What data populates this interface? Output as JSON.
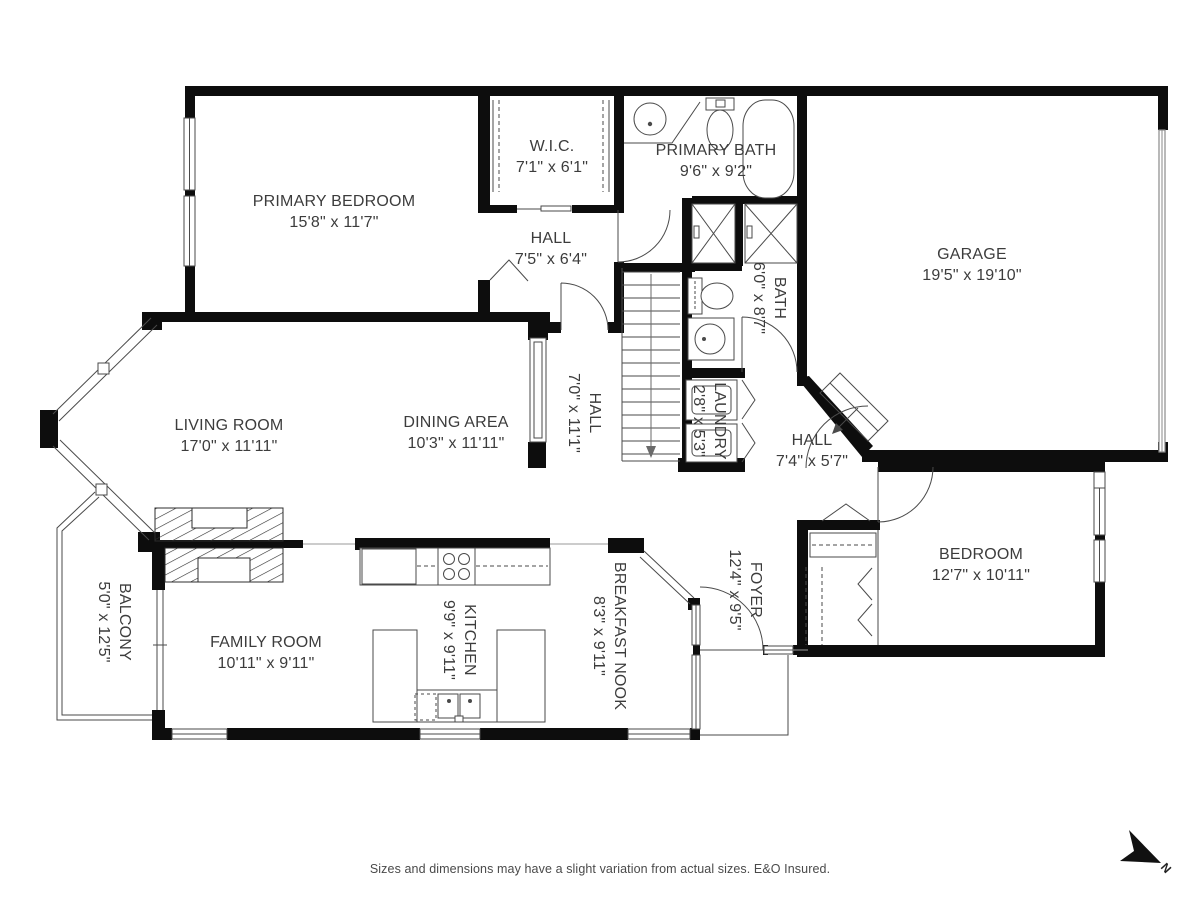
{
  "rooms": [
    {
      "id": "primary-bedroom",
      "name": "PRIMARY BEDROOM",
      "dims": "15'8\" x 11'7\""
    },
    {
      "id": "wic",
      "name": "W.I.C.",
      "dims": "7'1\" x 6'1\""
    },
    {
      "id": "primary-bath",
      "name": "PRIMARY BATH",
      "dims": "9'6\" x 9'2\""
    },
    {
      "id": "hall-upper",
      "name": "HALL",
      "dims": "7'5\" x 6'4\""
    },
    {
      "id": "garage",
      "name": "GARAGE",
      "dims": "19'5\" x 19'10\""
    },
    {
      "id": "bath",
      "name": "BATH",
      "dims": "6'0\" x 8'7\""
    },
    {
      "id": "hall-stairs",
      "name": "HALL",
      "dims": "7'0\" x 11'1\""
    },
    {
      "id": "laundry",
      "name": "LAUNDRY",
      "dims": "2'8\" x 5'3\""
    },
    {
      "id": "hall-lower",
      "name": "HALL",
      "dims": "7'4\" x 5'7\""
    },
    {
      "id": "living-room",
      "name": "LIVING ROOM",
      "dims": "17'0\" x 11'11\""
    },
    {
      "id": "dining-area",
      "name": "DINING AREA",
      "dims": "10'3\" x 11'11\""
    },
    {
      "id": "bedroom",
      "name": "BEDROOM",
      "dims": "12'7\" x 10'11\""
    },
    {
      "id": "foyer",
      "name": "FOYER",
      "dims": "12'4\" x 9'5\""
    },
    {
      "id": "balcony",
      "name": "BALCONY",
      "dims": "5'0\" x 12'5\""
    },
    {
      "id": "family-room",
      "name": "FAMILY ROOM",
      "dims": "10'11\" x 9'11\""
    },
    {
      "id": "kitchen",
      "name": "KITCHEN",
      "dims": "9'9\" x 9'11\""
    },
    {
      "id": "breakfast-nook",
      "name": "BREAKFAST NOOK",
      "dims": "8'3\" x 9'11\""
    }
  ],
  "footer": {
    "disclaimer": "Sizes and dimensions may have a slight variation from actual sizes. E&O Insured."
  },
  "compass": {
    "label": "N"
  }
}
